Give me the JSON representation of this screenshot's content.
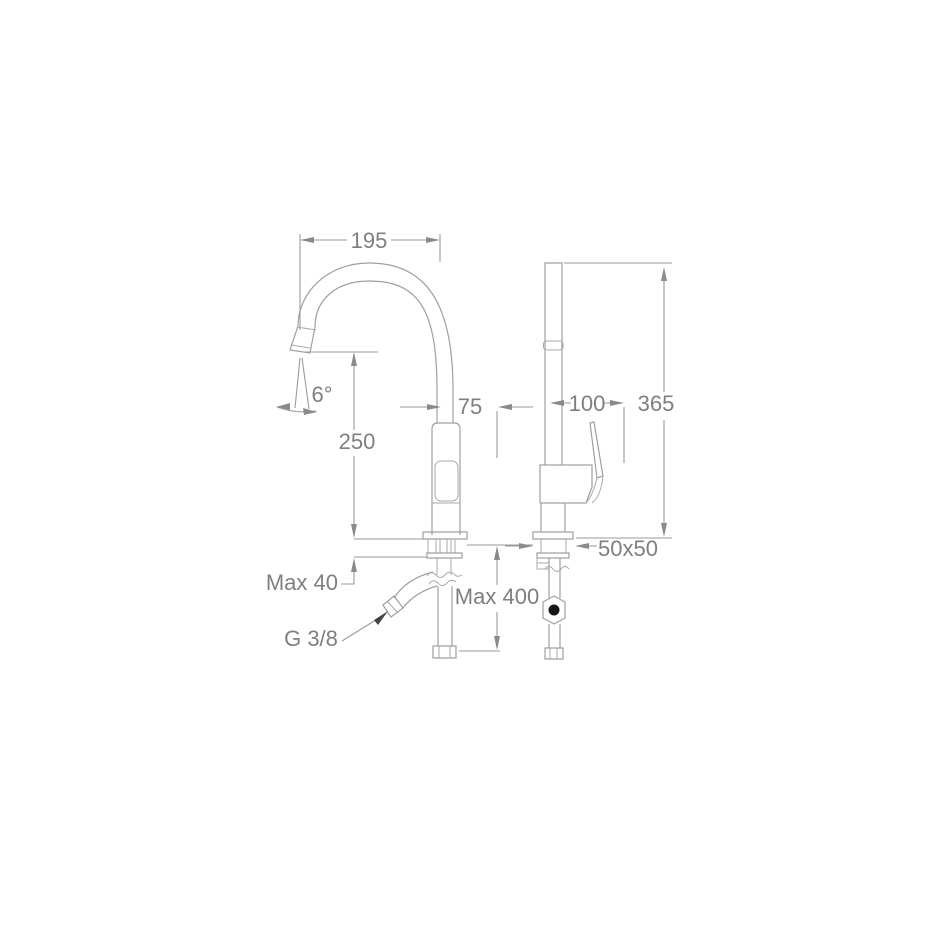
{
  "drawing": {
    "title": "faucet-dimension-drawing",
    "background_color": "#ffffff",
    "line_color": "#a0a0a0",
    "text_color": "#7f7f7f",
    "labels": {
      "spout_reach": "195",
      "spout_angle": "6°",
      "outlet_height": "250",
      "body_offset": "75",
      "deck_thickness_max": "Max 40",
      "inlet_thread": "G 3/8",
      "hose_length_max": "Max 400",
      "depth": "100",
      "total_height": "365",
      "base_size": "50x50"
    }
  }
}
